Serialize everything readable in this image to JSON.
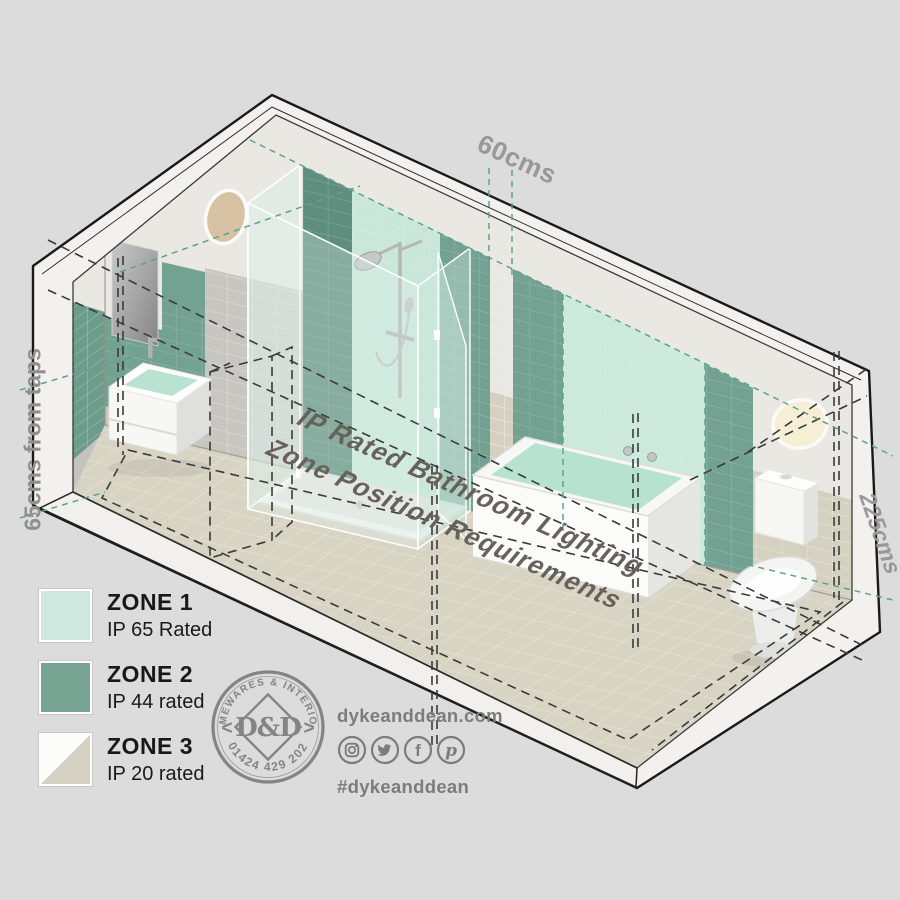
{
  "illustration": {
    "title_line1": "IP Rated Bathroom Lighting",
    "title_line2": "Zone Position Requirements",
    "dim_top": "60cms",
    "dim_left": "65cms from taps",
    "dim_right": "225cms"
  },
  "legend": {
    "items": [
      {
        "zone": "ZONE 1",
        "rating": "IP 65 Rated",
        "swatch": "#cfe8df",
        "swatch2": "#cfe8df"
      },
      {
        "zone": "ZONE 2",
        "rating": "IP 44 rated",
        "swatch": "#76a392",
        "swatch2": "#76a392"
      },
      {
        "zone": "ZONE 3",
        "rating": "IP 20 rated",
        "swatch": "#fbfbf8",
        "swatch2": "#d5d1c2"
      }
    ]
  },
  "logo": {
    "arc_top": "HOMEWARES & INTERIORS",
    "arc_bottom": "01424 429 202",
    "monogram": "D&D",
    "chevron_left": "<",
    "chevron_right": ">"
  },
  "contact": {
    "website": "dykeanddean.com",
    "hashtag": "#dykeanddean",
    "social": [
      {
        "name": "instagram-icon",
        "glyph": ""
      },
      {
        "name": "twitter-icon",
        "glyph": ""
      },
      {
        "name": "facebook-icon",
        "glyph": "f"
      },
      {
        "name": "pinterest-icon",
        "glyph": "p"
      }
    ]
  },
  "palette": {
    "background": "#dcdcdc",
    "zone1_mint": "#cfe8df",
    "zone2_green": "#76a392",
    "zone3_beige": "#d5d1c2",
    "floor_beige": "#d8d4c4",
    "teal_dash": "#5fa18d",
    "black_dash": "#3a3a3a",
    "label_gray": "#98989a",
    "text_dark": "#191919",
    "logo_gray": "#848484"
  }
}
